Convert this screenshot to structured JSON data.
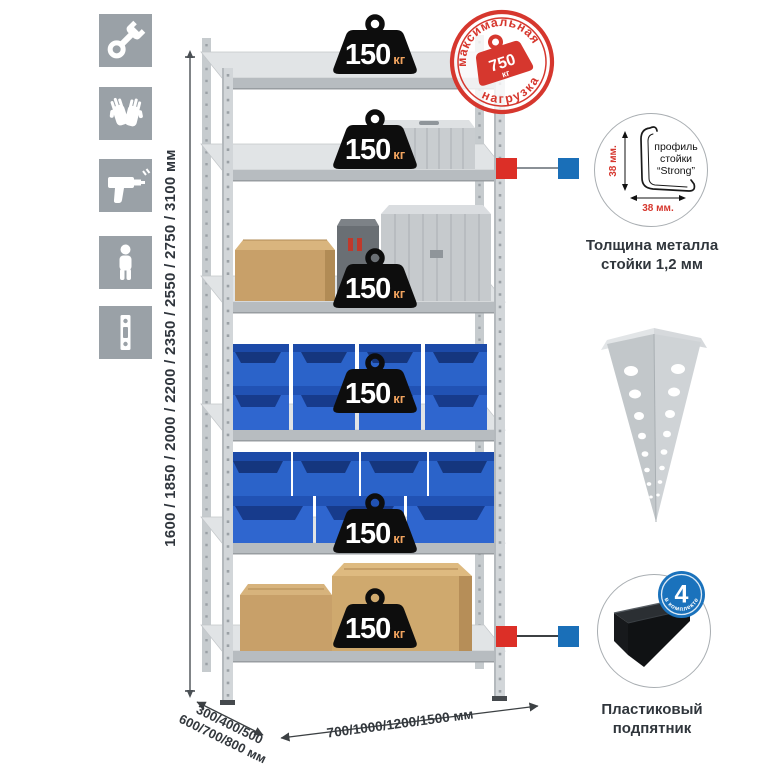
{
  "sidebar": {
    "icons": [
      {
        "name": "wrench"
      },
      {
        "name": "gloves"
      },
      {
        "name": "drill"
      },
      {
        "name": "person"
      },
      {
        "name": "profile-strip"
      }
    ]
  },
  "dimensions": {
    "height": "1600 / 1850 / 2000 / 2200 / 2350 / 2550 / 2750 / 3100 мм",
    "depth_line1": "300/400/500",
    "depth_line2": "600/700/800 мм",
    "width": "700/1000/1200/1500 мм"
  },
  "shelf_weight": {
    "value": "150",
    "unit": "кг"
  },
  "stamp": {
    "arc_top": "максимальная",
    "arc_bottom": "нагрузка",
    "value": "750",
    "unit": "кг"
  },
  "profile": {
    "dim_vertical": "38 мм.",
    "dim_horizontal": "38 мм.",
    "label_1": "профиль",
    "label_2": "стойки",
    "label_3": "“Strong”",
    "caption_1": "Толщина металла",
    "caption_2": "стойки 1,2 мм"
  },
  "foot": {
    "badge_value": "4",
    "badge_arc": "в комплекте",
    "caption_1": "Пластиковый",
    "caption_2": "подпятник"
  },
  "colors": {
    "red": "#d6372e",
    "blue": "#1a6fb8",
    "tile_gray": "#9aa1a7",
    "metal_gray": "#d2d6d9"
  }
}
